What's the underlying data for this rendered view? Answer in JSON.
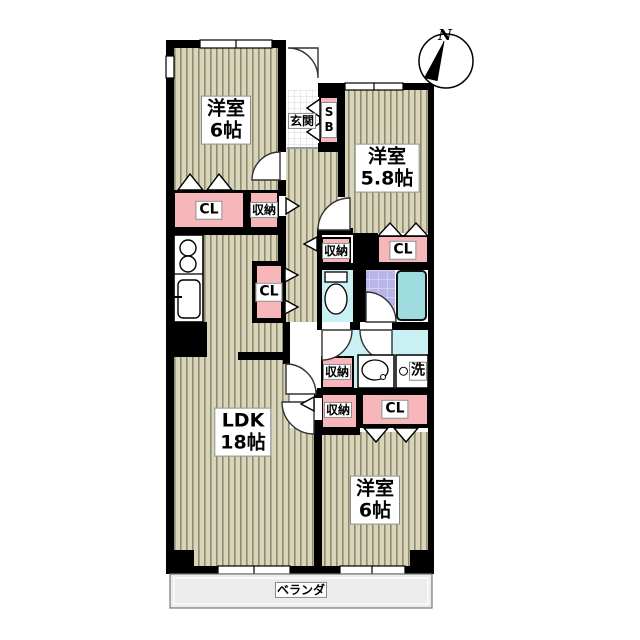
{
  "plan_type": "apartment-floorplan",
  "compass": {
    "north_label": "N"
  },
  "rooms": {
    "bedroom_nw": {
      "name": "洋室",
      "size": "6帖"
    },
    "bedroom_ne": {
      "name": "洋室",
      "size": "5.8帖"
    },
    "ldk": {
      "name": "LDK",
      "size": "18帖"
    },
    "bedroom_se": {
      "name": "洋室",
      "size": "6帖"
    },
    "entrance": {
      "label": "玄関"
    },
    "balcony": {
      "label": "ベランダ"
    }
  },
  "storage": {
    "shoe_box": {
      "label": "SB"
    },
    "closet_nw": {
      "label": "CL"
    },
    "storage_nw": {
      "label": "収納"
    },
    "storage_hall_upper": {
      "label": "収納"
    },
    "closet_ne": {
      "label": "CL"
    },
    "closet_kitchen": {
      "label": "CL"
    },
    "storage_washroom": {
      "label": "収納"
    },
    "storage_hall_lower": {
      "label": "収納"
    },
    "closet_se": {
      "label": "CL"
    }
  },
  "fixtures": {
    "laundry": {
      "label": "洗"
    }
  },
  "palette": {
    "wall": "#000000",
    "floor_wood": "#d9d5b8",
    "floor_stripe": "#8e8a74",
    "closet_pink": "#f6b6ba",
    "wet_area_cyan": "#c9f0f2",
    "bath_tile": "#b9b5e8",
    "bathtub": "#9fdce0",
    "balcony_gray": "#ececec",
    "label_bg": "#ffffff"
  }
}
